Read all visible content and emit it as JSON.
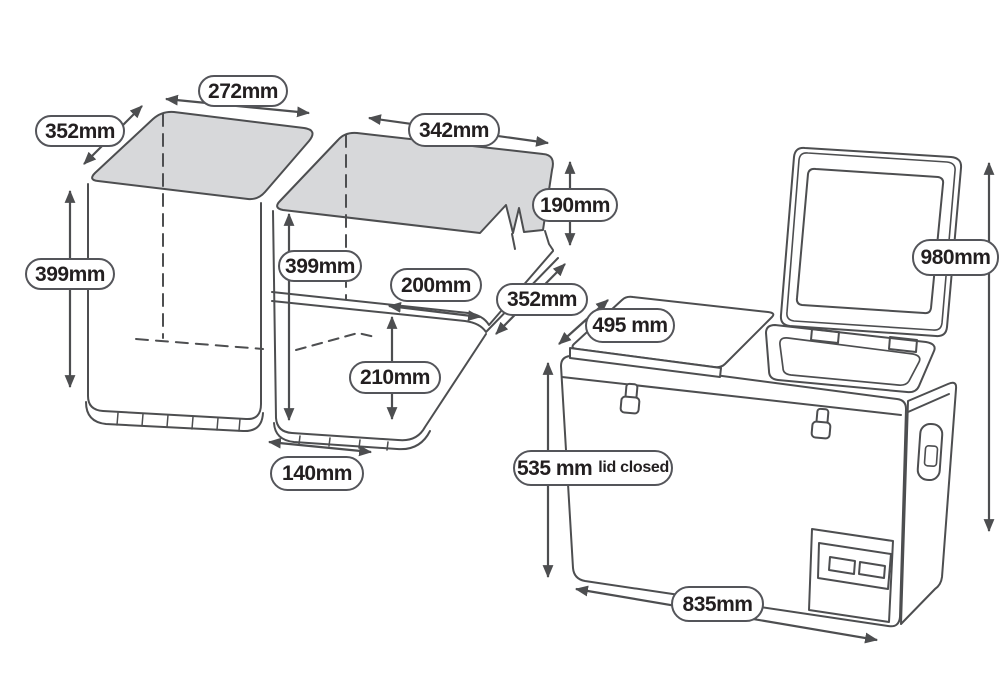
{
  "labels": {
    "left_width": "272mm",
    "left_depth": "352mm",
    "left_height": "399mm",
    "mid_width": "342mm",
    "mid_step_height": "190mm",
    "mid_height": "399mm",
    "mid_step_width": "200mm",
    "mid_depth": "352mm",
    "mid_lower_height": "210mm",
    "mid_lower_width": "140mm",
    "fridge_depth": "495 mm",
    "fridge_total_height": "980mm",
    "fridge_body_height": "535 mm",
    "fridge_body_height_note": "lid closed",
    "fridge_width": "835mm"
  },
  "colors": {
    "outline": "#4d4e50",
    "lid_fill": "#d7d8da",
    "label_border": "#54555a",
    "label_background": "#ffffff",
    "label_text": "#231f20"
  }
}
